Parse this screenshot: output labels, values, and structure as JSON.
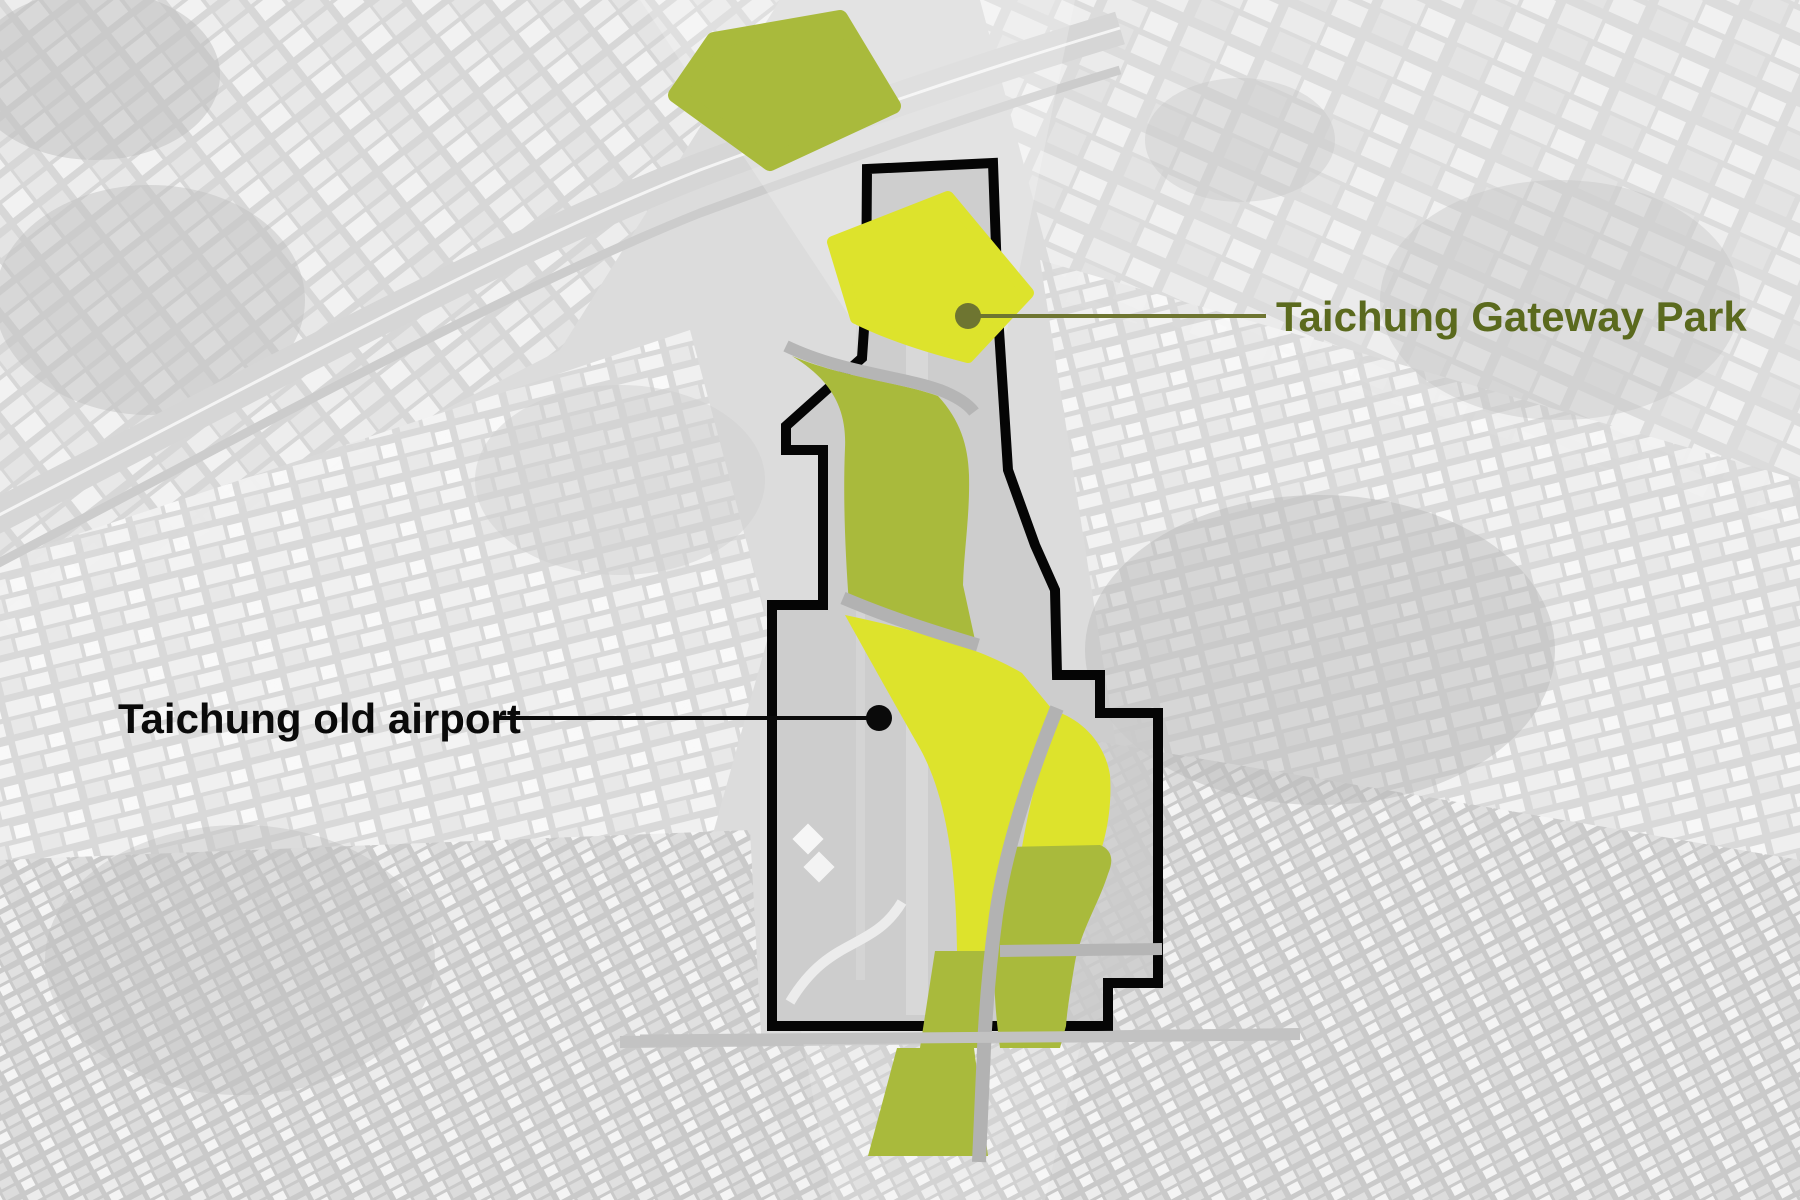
{
  "title": "Taichung old airport / Taichung Gateway Park site plan",
  "labels": {
    "gateway_park": "Taichung Gateway Park",
    "old_airport": "Taichung old airport"
  },
  "colors": {
    "park_highlight": "#dde32c",
    "park_secondary": "#a9ba3c",
    "site_boundary": "#050505",
    "gateway_label_text": "#5b6a1e",
    "airport_label_text": "#0a0a0a",
    "gateway_leader": "#6e7531",
    "airport_leader": "#0a0a0a"
  }
}
